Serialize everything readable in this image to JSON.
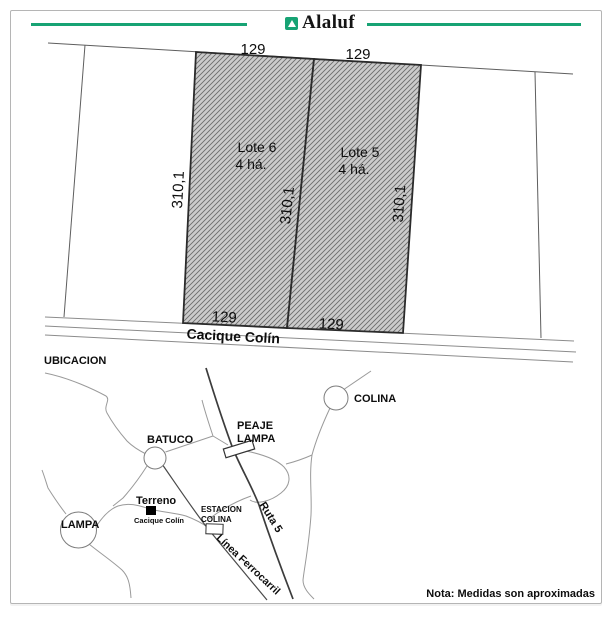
{
  "header": {
    "brand": "Alaluf",
    "accent_color": "#17a374"
  },
  "plan": {
    "road_name": "Cacique Colín",
    "lots": [
      {
        "name": "Lote 6",
        "area": "4 há.",
        "width_top": "129",
        "width_bottom": "129",
        "depth_left": "310,1"
      },
      {
        "name": "Lote 5",
        "area": "4 há.",
        "width_top": "129",
        "width_bottom": "129",
        "depth_left": "310,1",
        "depth_right": "310,1"
      }
    ]
  },
  "map": {
    "title": "UBICACION",
    "places": {
      "colina": "COLINA",
      "batuco": "BATUCO",
      "lampa": "LAMPA",
      "peaje_line1": "PEAJE",
      "peaje_line2": "LAMPA",
      "estacion_line1": "ESTACION",
      "estacion_line2": "COLINA",
      "terreno": "Terreno",
      "terreno_road": "Cacique Colín",
      "ruta": "Ruta 5",
      "ferrocarril": "Línea Ferrocarril"
    }
  },
  "note": "Nota: Medidas son aproximadas"
}
